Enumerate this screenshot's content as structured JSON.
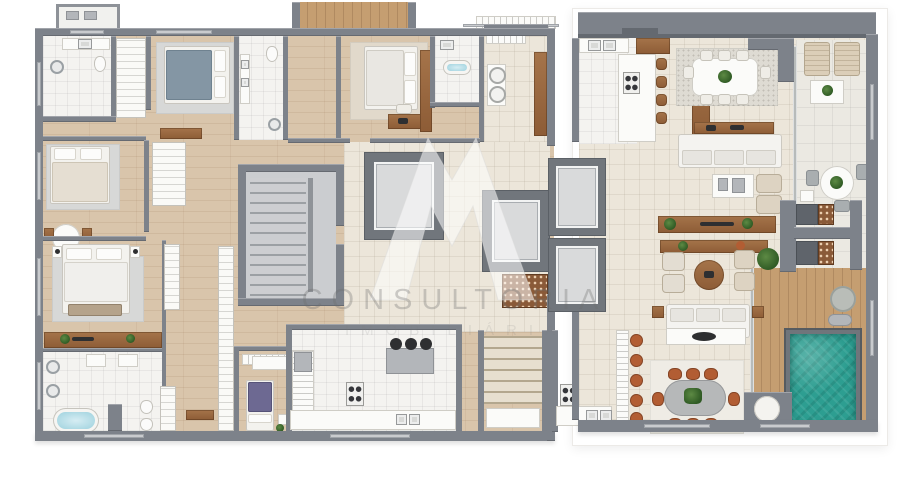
{
  "watermark": {
    "monogram": "M",
    "title": "CONSULTORIA",
    "subtitle": "IMOBILIÁRIA"
  },
  "palette": {
    "wall_gray": "#7d828a",
    "wood_floor": "#d9c5ab",
    "deck_wood": "#c59e71",
    "tile_cream": "#ece6da",
    "tile_white": "#f4f3f0",
    "pool_water": "#2d9e91",
    "pool_coping": "#70757b",
    "terracotta_chair": "#b25d33",
    "bed_blue": "#8496a4",
    "bed_purple": "#6d6992",
    "plant_green": "#3f6d2f",
    "furniture_wood": "#9a6a42"
  },
  "plan_inventory": {
    "type": "residential-floor-plan",
    "features": [
      "bedrooms",
      "bathrooms",
      "kitchens",
      "living-rooms",
      "dining-rooms",
      "laundry",
      "stair-cores",
      "elevators",
      "wine-racks",
      "terrace",
      "wood-deck",
      "swimming-pool"
    ]
  }
}
